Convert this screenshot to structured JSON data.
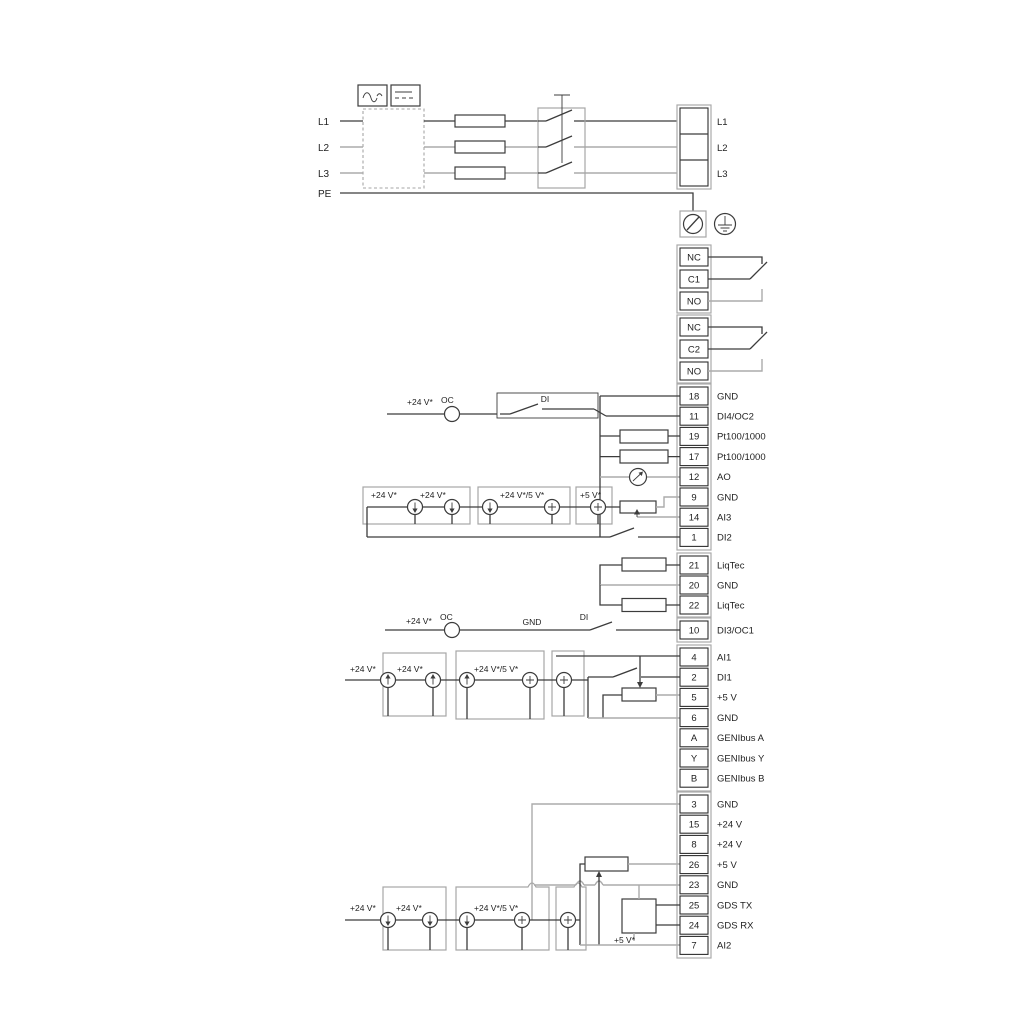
{
  "power": {
    "in": [
      "L1",
      "L2",
      "L3",
      "PE"
    ],
    "out": [
      "L1",
      "L2",
      "L3"
    ]
  },
  "relays": {
    "r1": [
      "NC",
      "C1",
      "NO"
    ],
    "r2": [
      "NC",
      "C2",
      "NO"
    ]
  },
  "groupA": [
    {
      "n": "18",
      "label": "GND"
    },
    {
      "n": "11",
      "label": "DI4/OC2"
    },
    {
      "n": "19",
      "label": "Pt100/1000"
    },
    {
      "n": "17",
      "label": "Pt100/1000"
    },
    {
      "n": "12",
      "label": "AO"
    },
    {
      "n": "9",
      "label": "GND"
    },
    {
      "n": "14",
      "label": "AI3"
    },
    {
      "n": "1",
      "label": "DI2"
    }
  ],
  "liqtec": [
    {
      "n": "21",
      "label": "LiqTec"
    },
    {
      "n": "20",
      "label": "GND"
    },
    {
      "n": "22",
      "label": "LiqTec"
    }
  ],
  "di3": {
    "n": "10",
    "label": "DI3/OC1"
  },
  "groupB": [
    {
      "n": "4",
      "label": "AI1"
    },
    {
      "n": "2",
      "label": "DI1"
    },
    {
      "n": "5",
      "label": "+5 V"
    },
    {
      "n": "6",
      "label": "GND"
    },
    {
      "n": "A",
      "label": "GENIbus A"
    },
    {
      "n": "Y",
      "label": "GENIbus Y"
    },
    {
      "n": "B",
      "label": "GENIbus B"
    }
  ],
  "groupC": [
    {
      "n": "3",
      "label": "GND"
    },
    {
      "n": "15",
      "label": "+24 V"
    },
    {
      "n": "8",
      "label": "+24 V"
    },
    {
      "n": "26",
      "label": "+5 V"
    },
    {
      "n": "23",
      "label": "GND"
    },
    {
      "n": "25",
      "label": "GDS TX"
    },
    {
      "n": "24",
      "label": "GDS RX"
    },
    {
      "n": "7",
      "label": "AI2"
    }
  ],
  "ann": {
    "v24": "+24 V*",
    "v24_5": "+24 V*/5 V*",
    "v5": "+5 V*",
    "oc": "OC",
    "di": "DI",
    "gnd": "GND"
  },
  "colors": {
    "wire": "#3c3c3c",
    "wire_gray": "#ababab",
    "frame": "#a6a6a6"
  }
}
